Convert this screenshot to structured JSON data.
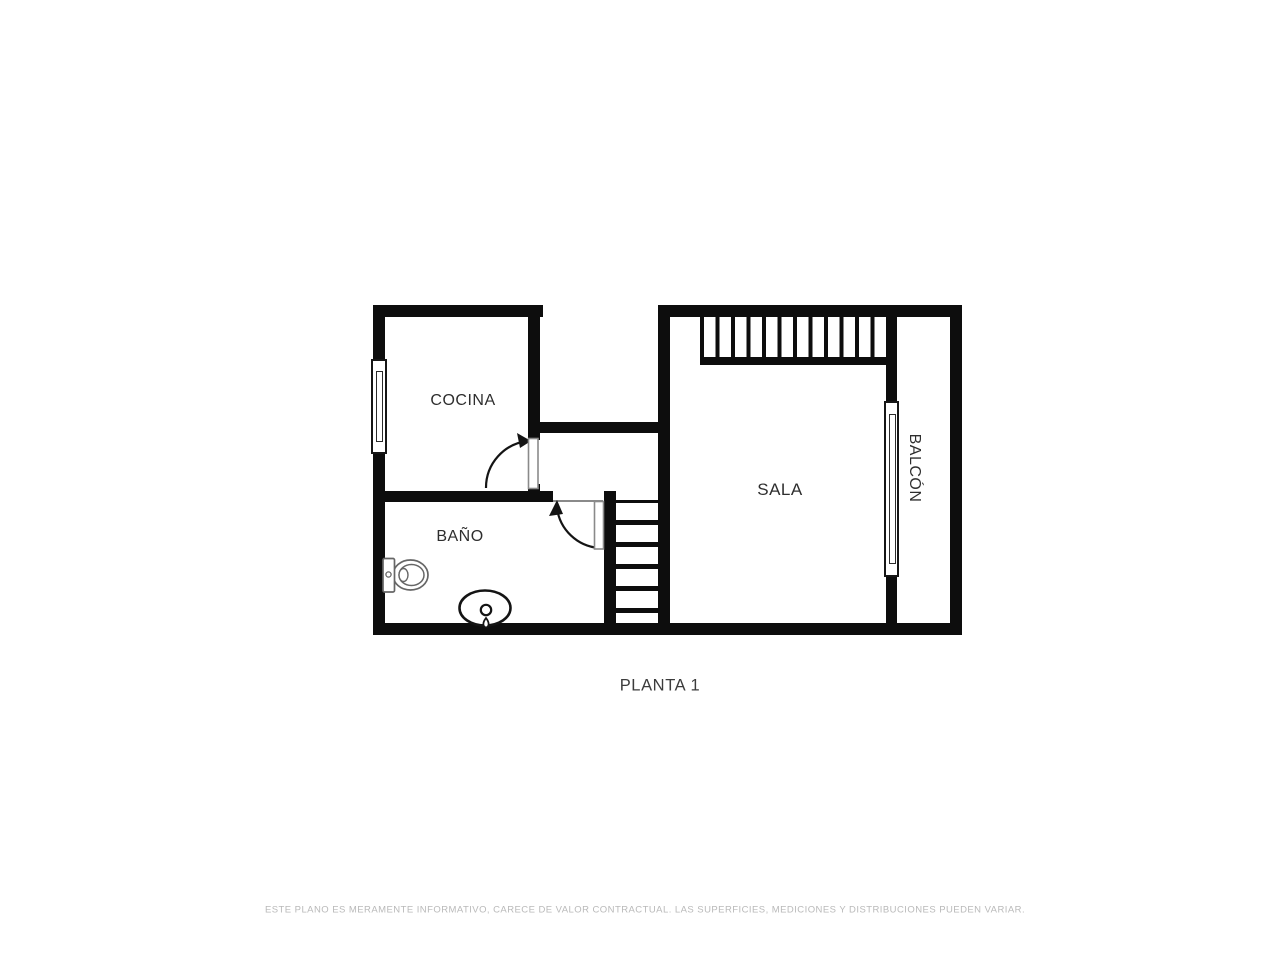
{
  "plan": {
    "title": "PLANTA 1",
    "rooms": {
      "cocina": "COCINA",
      "bano": "BAÑO",
      "sala": "SALA",
      "balcon": "BALCÓN"
    },
    "disclaimer": "ESTE PLANO ES MERAMENTE INFORMATIVO, CARECE DE VALOR CONTRACTUAL. LAS SUPERFICIES, MEDICIONES Y DISTRIBUCIONES PUEDEN VARIAR.",
    "fixtures": {
      "toilet": "toilet-icon",
      "sink": "sink-icon"
    },
    "stairs": {
      "upper": "stairs-upper",
      "lower": "stairs-lower"
    },
    "colors": {
      "wall": "#0d0d0d",
      "background": "#ffffff",
      "label": "#2e2e2e",
      "title": "#3c3c3c",
      "disclaimer": "#b9b9b9",
      "door_leaf_outline": "#8a8a8a",
      "fixture_outline": "#666666"
    }
  }
}
